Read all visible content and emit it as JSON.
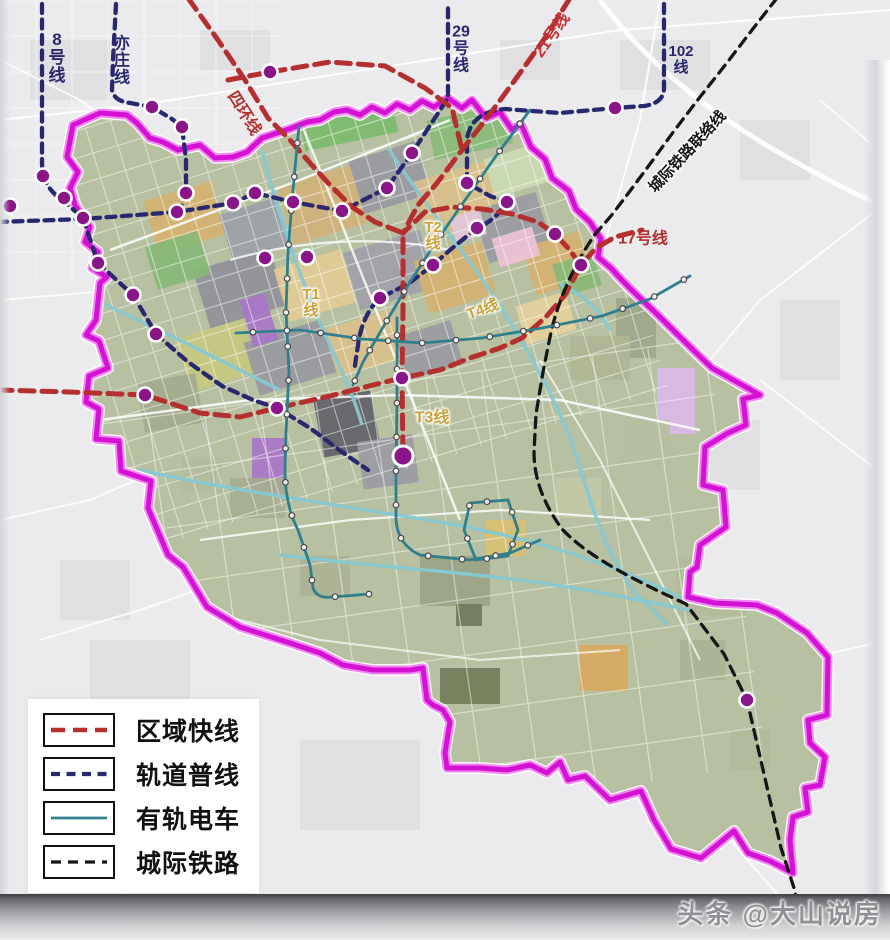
{
  "watermark": "头条 @大山说房",
  "legend": {
    "items": [
      {
        "label": "区域快线",
        "type": "regional"
      },
      {
        "label": "轨道普线",
        "type": "metro"
      },
      {
        "label": "有轨电车",
        "type": "tram"
      },
      {
        "label": "城际铁路",
        "type": "intercity"
      }
    ]
  },
  "colors": {
    "background_outside": "#ebebee",
    "land_base": "#b7c0a0",
    "boundary": "#d312d3",
    "boundary_glow": "#f27af2",
    "regional_express": "#b52f2f",
    "metro_normal": "#28286e",
    "tram": "#2f7f8c",
    "intercity": "#161616",
    "station": "#8a1588",
    "waterway": "#86c8d2"
  },
  "map": {
    "line_types": {
      "regional": {
        "c": "#b52f2f",
        "w": 5,
        "d": "14 8"
      },
      "metro": {
        "c": "#28286e",
        "w": 4.3,
        "d": "9 6.5"
      },
      "tram": {
        "c": "#2f7f8c",
        "w": 2.8,
        "d": ""
      },
      "intercity": {
        "c": "#161616",
        "w": 3.3,
        "d": "10 7"
      }
    },
    "boundary_path": "M448,98 L462,108 472,100 486,118 500,112 512,130 521,124 531,147 545,159 552,178 569,191 576,209 590,222 601,239 598,257 612,269 C628,288 645,302 661,318 C677,334 695,352 712,368 L760,395 743,399 746,425 728,433 705,447 703,485 723,490 726,527 700,545 697,567 690,572 688,597 715,603 757,605 777,613 807,633 828,657 827,715 808,720 810,743 825,757 820,785 805,788 808,812 793,817 790,840 793,873 770,861 748,853 734,831 701,858 671,849 654,820 641,791 610,800 585,776 568,780 560,762 547,773 530,765 507,770 480,768 447,768 445,753 450,722 443,710 433,705 427,700 423,668 410,670 373,670 343,665 320,653 290,643 240,627 207,607 183,567 168,555 148,508 151,481 121,471 119,441 96,439 99,409 86,402 89,376 108,368 99,341 86,335 96,320 100,283 107,277 92,268 98,252 85,242 90,227 75,205 70,188 78,172 67,157 73,125 100,113 127,115 137,123 150,138 163,142 178,150 200,145 215,158 233,157 247,152 262,138 277,133 292,128 307,122 320,120 334,112 347,110 360,115 372,107 385,113 397,104 410,110 422,101 434,107 Z",
    "transit_lines": [
      {
        "name": "line-8",
        "type": "metro",
        "d": "M42,4 L42,165 Q44,188 60,198 L83,218"
      },
      {
        "name": "yizhuang-line",
        "type": "metro",
        "d": "M116,4 L113,60 112,90 Q114,101 130,103 L152,107 172,119 182,127 186,160 186,193 180,210"
      },
      {
        "name": "line-29-west",
        "type": "metro",
        "d": "M-2,222 L83,219 177,212 233,203 255,193 293,202 342,211 387,188 412,153 448,98 448,4"
      },
      {
        "name": "line-102-ne",
        "type": "metro",
        "d": "M664,4 L664,88 Q664,103 644,106 L615,108 560,113 505,109 Q470,112 467,140 L467,183 490,196 507,202 Q496,220 477,228 L450,250 433,265 408,284 380,298 Q362,315 358,345 L354,372"
      },
      {
        "name": "sw-branch",
        "type": "metro",
        "d": "M83,218 L98,263 133,295 156,334 188,362 222,386 253,400 277,408 310,428 342,452 368,470"
      },
      {
        "name": "ring4-south",
        "type": "regional",
        "d": "M188,-2 L218,40 245,80 268,118 290,140 310,163 330,185 352,207 375,222 403,233 403,310 402,378 403,456"
      },
      {
        "name": "line-21",
        "type": "regional",
        "d": "M570,-2 L545,38 515,80 487,118 462,150 437,183 418,205 403,233"
      },
      {
        "name": "red-top-east",
        "type": "regional",
        "d": "M228,80 L270,72 330,62 385,66 425,88 452,108 462,150"
      },
      {
        "name": "line-17-cross",
        "type": "regional",
        "d": "M-2,390 L70,392 145,395 200,413 240,417 277,408 330,396 365,387 402,378 440,370 470,358 500,348 522,338 545,318 565,295 581,265 596,248 615,237 642,230"
      },
      {
        "name": "line-17-spur",
        "type": "regional",
        "d": "M581,265 L568,248 555,234 538,222 512,214 482,209 452,207 425,212 403,233"
      },
      {
        "name": "intercity-rail",
        "type": "intercity",
        "d": "M777,-2 L752,30 726,64 700,97 674,131 650,164 630,191 611,216 596,233 C578,258 560,294 551,332 L543,372 536,414 534,452 C534,482 546,507 562,529 C588,557 636,581 686,604 L724,654 747,700 764,774 781,848 794,888 801,918"
      },
      {
        "name": "tram-t1",
        "type": "tram",
        "d": "M299,126 L293,190 288,252 286,312 289,372 286,432 285,470 Q285,505 298,530 L310,565 313,588 Q317,599 332,597 L370,594"
      },
      {
        "name": "tram-t2",
        "type": "tram",
        "d": "M530,110 L496,156 463,203 436,242 410,282 386,322 363,362 353,385"
      },
      {
        "name": "tram-t4",
        "type": "tram",
        "d": "M236,333 L300,330 362,339 422,343 482,338 542,328 602,316 650,299 690,276"
      },
      {
        "name": "tram-t3",
        "type": "tram",
        "d": "M397,318 L397,400 396,470 396,520 Q398,545 420,555 L470,560 510,553 540,540"
      },
      {
        "name": "tram-loop",
        "type": "tram",
        "d": "M470,503 L508,500 518,530 508,556 476,560 464,530 Z"
      }
    ],
    "metro_stations": [
      [
        10,
        206
      ],
      [
        43,
        176
      ],
      [
        64,
        198
      ],
      [
        83,
        218
      ],
      [
        152,
        107
      ],
      [
        182,
        127
      ],
      [
        186,
        193
      ],
      [
        177,
        212
      ],
      [
        233,
        203
      ],
      [
        255,
        193
      ],
      [
        293,
        202
      ],
      [
        265,
        258
      ],
      [
        307,
        257
      ],
      [
        342,
        211
      ],
      [
        387,
        188
      ],
      [
        412,
        153
      ],
      [
        98,
        263
      ],
      [
        133,
        295
      ],
      [
        156,
        334
      ],
      [
        145,
        395
      ],
      [
        277,
        408
      ],
      [
        402,
        378
      ],
      [
        433,
        265
      ],
      [
        380,
        298
      ],
      [
        467,
        183
      ],
      [
        507,
        202
      ],
      [
        477,
        228
      ],
      [
        555,
        234
      ],
      [
        581,
        265
      ],
      [
        615,
        108
      ],
      [
        270,
        72
      ],
      [
        747,
        700
      ]
    ],
    "terminal_stations": [
      [
        403,
        456
      ]
    ],
    "labels": [
      {
        "t": "8\n号\n线",
        "x": 57,
        "y": 58,
        "s": 17,
        "c": "#28286e",
        "b": 1
      },
      {
        "t": "亦\n庄\n线",
        "x": 122,
        "y": 62,
        "s": 16,
        "c": "#28286e",
        "b": 1
      },
      {
        "t": "四环线",
        "x": 243,
        "y": 114,
        "s": 16,
        "c": "#b03232",
        "b": 1,
        "r": 58
      },
      {
        "t": "29\n号\n线",
        "x": 461,
        "y": 50,
        "s": 16,
        "c": "#28286e",
        "b": 1
      },
      {
        "t": "21号线",
        "x": 553,
        "y": 36,
        "s": 16,
        "c": "#c23434",
        "b": 1,
        "r": -55
      },
      {
        "t": "102\n线",
        "x": 681,
        "y": 60,
        "s": 15,
        "c": "#28286e",
        "b": 1
      },
      {
        "t": "城际铁路联络线",
        "x": 688,
        "y": 152,
        "s": 15,
        "c": "#161616",
        "b": 1,
        "r": -47,
        "g": 1
      },
      {
        "t": "17号线",
        "x": 643,
        "y": 240,
        "s": 16,
        "c": "#b53030",
        "b": 1
      },
      {
        "t": "T1\n线",
        "x": 311,
        "y": 303,
        "s": 15,
        "c": "#c9a23a",
        "b": 1,
        "g": 1
      },
      {
        "t": "T2\n线",
        "x": 433,
        "y": 236,
        "s": 15,
        "c": "#c9a23a",
        "b": 1,
        "g": 1
      },
      {
        "t": "T4线",
        "x": 483,
        "y": 310,
        "s": 15,
        "c": "#c9a23a",
        "b": 1,
        "g": 1,
        "r": -20
      },
      {
        "t": "T3线",
        "x": 432,
        "y": 419,
        "s": 16,
        "c": "#c9a23a",
        "b": 1,
        "g": 1
      }
    ],
    "land_patches": [
      {
        "x": 150,
        "y": 190,
        "w": 70,
        "h": 55,
        "f": "#d6b170",
        "r": -17
      },
      {
        "x": 225,
        "y": 205,
        "w": 60,
        "h": 50,
        "f": "#9aa0a6",
        "r": -17
      },
      {
        "x": 285,
        "y": 175,
        "w": 75,
        "h": 60,
        "f": "#d2b178",
        "r": -17
      },
      {
        "x": 355,
        "y": 150,
        "w": 70,
        "h": 55,
        "f": "#98989f",
        "r": -17
      },
      {
        "x": 420,
        "y": 170,
        "w": 75,
        "h": 60,
        "f": "#dcc08a",
        "r": -17
      },
      {
        "x": 480,
        "y": 200,
        "w": 65,
        "h": 55,
        "f": "#9a9aa2",
        "r": -17
      },
      {
        "x": 528,
        "y": 238,
        "w": 60,
        "h": 50,
        "f": "#d6b170",
        "r": -17
      },
      {
        "x": 200,
        "y": 258,
        "w": 80,
        "h": 60,
        "f": "#90909a",
        "r": -17
      },
      {
        "x": 280,
        "y": 258,
        "w": 70,
        "h": 55,
        "f": "#e2cb92",
        "r": -17
      },
      {
        "x": 350,
        "y": 240,
        "w": 80,
        "h": 60,
        "f": "#a0a0a8",
        "r": -17
      },
      {
        "x": 420,
        "y": 250,
        "w": 70,
        "h": 55,
        "f": "#d6b170",
        "r": -17
      },
      {
        "x": 182,
        "y": 328,
        "w": 70,
        "h": 55,
        "f": "#c8c87e",
        "r": -17
      },
      {
        "x": 250,
        "y": 330,
        "w": 80,
        "h": 55,
        "f": "#98989f",
        "r": -17
      },
      {
        "x": 330,
        "y": 318,
        "w": 70,
        "h": 50,
        "f": "#dcc08a",
        "r": -17
      },
      {
        "x": 398,
        "y": 328,
        "w": 60,
        "h": 45,
        "f": "#9a9aa2",
        "r": -17
      },
      {
        "x": 318,
        "y": 395,
        "w": 58,
        "h": 58,
        "f": "#5f5f67",
        "r": -10
      },
      {
        "x": 150,
        "y": 238,
        "w": 55,
        "h": 45,
        "f": "#86b877",
        "r": -17
      },
      {
        "x": 300,
        "y": 100,
        "w": 95,
        "h": 42,
        "f": "#7aba6b",
        "r": -12
      },
      {
        "x": 430,
        "y": 112,
        "w": 80,
        "h": 40,
        "f": "#88ba78",
        "r": -12
      },
      {
        "x": 488,
        "y": 150,
        "w": 60,
        "h": 40,
        "f": "#ccdcb2",
        "r": -17
      },
      {
        "x": 246,
        "y": 296,
        "w": 26,
        "h": 48,
        "f": "#a874c8",
        "r": -17
      },
      {
        "x": 252,
        "y": 438,
        "w": 34,
        "h": 56,
        "f": "#a874c8",
        "r": 0
      },
      {
        "x": 657,
        "y": 368,
        "w": 38,
        "h": 66,
        "f": "#dcb8e8",
        "r": 0
      },
      {
        "x": 580,
        "y": 645,
        "w": 48,
        "h": 46,
        "f": "#d8a85e",
        "r": 0
      },
      {
        "x": 495,
        "y": 232,
        "w": 42,
        "h": 30,
        "f": "#eec2d8",
        "r": -17
      },
      {
        "x": 452,
        "y": 213,
        "w": 32,
        "h": 26,
        "f": "#e6c8dc",
        "r": -17
      },
      {
        "x": 520,
        "y": 298,
        "w": 52,
        "h": 40,
        "f": "#e6d29c",
        "r": -17
      },
      {
        "x": 556,
        "y": 258,
        "w": 42,
        "h": 34,
        "f": "#86b877",
        "r": -17
      },
      {
        "x": 140,
        "y": 378,
        "w": 60,
        "h": 50,
        "f": "#a3ab8e",
        "r": -10
      },
      {
        "x": 360,
        "y": 438,
        "w": 56,
        "h": 48,
        "f": "#9a9aa2",
        "r": -8
      },
      {
        "x": 230,
        "y": 478,
        "w": 55,
        "h": 40,
        "f": "#a6ae90",
        "r": 0
      },
      {
        "x": 182,
        "y": 458,
        "w": 40,
        "h": 35,
        "f": "#b3bb9b",
        "r": 0
      },
      {
        "x": 420,
        "y": 556,
        "w": 70,
        "h": 50,
        "f": "#9aa285",
        "r": 0
      },
      {
        "x": 300,
        "y": 556,
        "w": 50,
        "h": 40,
        "f": "#abb393",
        "r": 0
      },
      {
        "x": 676,
        "y": 556,
        "w": 70,
        "h": 60,
        "f": "#b1ba99",
        "r": 0
      },
      {
        "x": 556,
        "y": 478,
        "w": 45,
        "h": 40,
        "f": "#c1c9a6",
        "r": 0
      },
      {
        "x": 616,
        "y": 298,
        "w": 40,
        "h": 60,
        "f": "#9da689",
        "r": 0
      },
      {
        "x": 440,
        "y": 668,
        "w": 60,
        "h": 36,
        "f": "#707c58",
        "r": 0
      },
      {
        "x": 456,
        "y": 604,
        "w": 26,
        "h": 22,
        "f": "#6e7a56",
        "r": 0
      },
      {
        "x": 486,
        "y": 520,
        "w": 40,
        "h": 36,
        "f": "#d8c070",
        "r": 0
      },
      {
        "x": 570,
        "y": 336,
        "w": 60,
        "h": 44,
        "f": "#aeb694",
        "r": 0
      },
      {
        "x": 620,
        "y": 420,
        "w": 50,
        "h": 44,
        "f": "#b6bf9e",
        "r": 0
      },
      {
        "x": 680,
        "y": 640,
        "w": 45,
        "h": 40,
        "f": "#aab292",
        "r": 0
      },
      {
        "x": 730,
        "y": 730,
        "w": 40,
        "h": 40,
        "f": "#b1ba99",
        "r": 0
      }
    ],
    "grids": [
      {
        "x": 60,
        "y": 60,
        "w": 560,
        "h": 420,
        "step": 26,
        "rot": -17,
        "c": "#ffffff",
        "w2": 1.1,
        "o": 0.5,
        "inside": 1
      },
      {
        "x": 120,
        "y": 380,
        "w": 620,
        "h": 430,
        "step": 56,
        "rot": -8,
        "c": "#ffffff",
        "w2": 1.3,
        "o": 0.45,
        "inside": 1
      },
      {
        "x": 0,
        "y": 0,
        "w": 280,
        "h": 280,
        "step": 36,
        "rot": 0,
        "c": "#ffffff",
        "w2": 1,
        "o": 0.5,
        "inside": 0
      }
    ],
    "waterways": [
      {
        "d": "M388,148 C425,205 462,248 495,298 C525,345 550,388 572,442 C588,492 600,545 636,594 L668,625"
      },
      {
        "d": "M262,150 C278,215 300,280 330,345 C345,378 355,400 362,425"
      },
      {
        "d": "M95,300 C160,330 220,360 280,390"
      },
      {
        "d": "M140,470 C240,492 340,505 440,522 C540,540 610,562 690,602"
      },
      {
        "d": "M280,555 C360,565 440,570 520,580 C580,588 640,600 690,610"
      },
      {
        "d": "M560,284 C585,296 600,310 610,330"
      }
    ],
    "roads_inside": [
      {
        "d": "M110,250 L300,180 450,120",
        "w": 2.5,
        "o": 0.85
      },
      {
        "d": "M100,420 L250,400 400,395 560,400 700,430",
        "w": 2.5,
        "o": 0.85
      },
      {
        "d": "M300,120 L340,220 380,320 420,420 460,520",
        "w": 2.5,
        "o": 0.8
      },
      {
        "d": "M200,540 L350,520 500,510 650,520",
        "w": 2.2,
        "o": 0.8
      },
      {
        "d": "M230,260 C300,240 380,235 450,250",
        "w": 2.2,
        "o": 0.8
      },
      {
        "d": "M160,600 L320,640 480,660 620,650",
        "w": 2,
        "o": 0.7
      },
      {
        "d": "M540,360 L600,460 650,560 700,660",
        "w": 2,
        "o": 0.7
      }
    ],
    "roads_outside": [
      {
        "d": "M0,120 L140,105 300,80 460,55 620,30 890,10",
        "w": 2,
        "o": 0.9
      },
      {
        "d": "M600,0 C660,80 740,140 890,210",
        "w": 5,
        "o": 0.9
      },
      {
        "d": "M660,0 L640,120 600,260",
        "w": 2,
        "o": 0.85
      },
      {
        "d": "M890,200 L760,300 660,420 600,520",
        "w": 2,
        "o": 0.85
      },
      {
        "d": "M0,300 L120,290 240,270",
        "w": 2,
        "o": 0.8
      },
      {
        "d": "M0,60 L80,100 160,160",
        "w": 2,
        "o": 0.8
      },
      {
        "d": "M0,520 L90,500 160,470",
        "w": 2,
        "o": 0.8
      },
      {
        "d": "M40,640 L140,610 240,575",
        "w": 2,
        "o": 0.8
      },
      {
        "d": "M700,700 L800,660 890,640",
        "w": 2,
        "o": 0.8
      },
      {
        "d": "M820,100 L890,160",
        "w": 2,
        "o": 0.8
      },
      {
        "d": "M760,380 L890,480",
        "w": 2,
        "o": 0.8
      },
      {
        "d": "M640,760 L730,840 800,920",
        "w": 2,
        "o": 0.8
      }
    ],
    "outside_patches": [
      {
        "x": 620,
        "y": 40,
        "w": 90,
        "h": 50
      },
      {
        "x": 740,
        "y": 120,
        "w": 70,
        "h": 60
      },
      {
        "x": 30,
        "y": 40,
        "w": 80,
        "h": 60
      },
      {
        "x": 200,
        "y": 30,
        "w": 70,
        "h": 40
      },
      {
        "x": 680,
        "y": 420,
        "w": 80,
        "h": 70
      },
      {
        "x": 780,
        "y": 300,
        "w": 60,
        "h": 80
      },
      {
        "x": 60,
        "y": 560,
        "w": 70,
        "h": 60
      },
      {
        "x": 90,
        "y": 640,
        "w": 100,
        "h": 80
      },
      {
        "x": 500,
        "y": 40,
        "w": 60,
        "h": 40
      },
      {
        "x": 300,
        "y": 740,
        "w": 120,
        "h": 90
      }
    ]
  }
}
